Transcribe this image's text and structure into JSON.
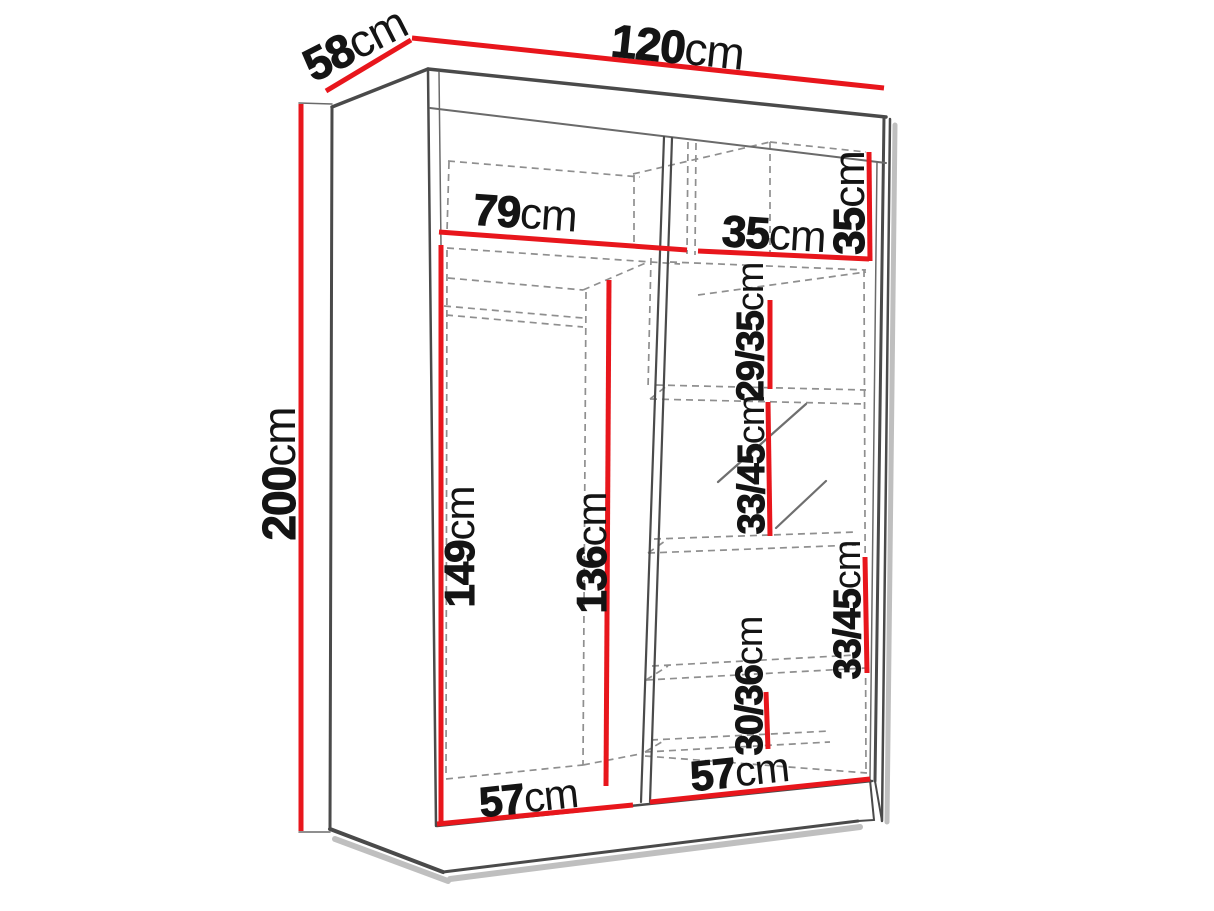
{
  "diagram": {
    "figure": "sliding-wardrobe-3d-dimension-diagram",
    "unit": "cm",
    "colors": {
      "dimension_line": "#e8161c",
      "edge": "#4a4a4a",
      "dashed_edge": "#8f8f8f",
      "label_text": "#141414",
      "background": "#ffffff"
    },
    "overall": {
      "width": {
        "value": "120",
        "unit": "cm"
      },
      "depth": {
        "value": "58",
        "unit": "cm"
      },
      "height": {
        "value": "200",
        "unit": "cm"
      }
    },
    "interior": {
      "top_shelf_left_width": {
        "value": "79",
        "unit": "cm"
      },
      "top_shelf_right_width": {
        "value": "35",
        "unit": "cm"
      },
      "top_shelf_right_height": {
        "value": "35",
        "unit": "cm"
      },
      "right_shelf_gap_1": {
        "value": "29/35",
        "unit": "cm"
      },
      "right_shelf_gap_2": {
        "value": "33/45",
        "unit": "cm"
      },
      "right_shelf_gap_3": {
        "value": "33/45",
        "unit": "cm"
      },
      "right_shelf_gap_4": {
        "value": "30/36",
        "unit": "cm"
      },
      "left_section_height": {
        "value": "149",
        "unit": "cm"
      },
      "left_inner_height": {
        "value": "136",
        "unit": "cm"
      },
      "left_bottom_width": {
        "value": "57",
        "unit": "cm"
      },
      "right_bottom_width": {
        "value": "57",
        "unit": "cm"
      }
    }
  }
}
